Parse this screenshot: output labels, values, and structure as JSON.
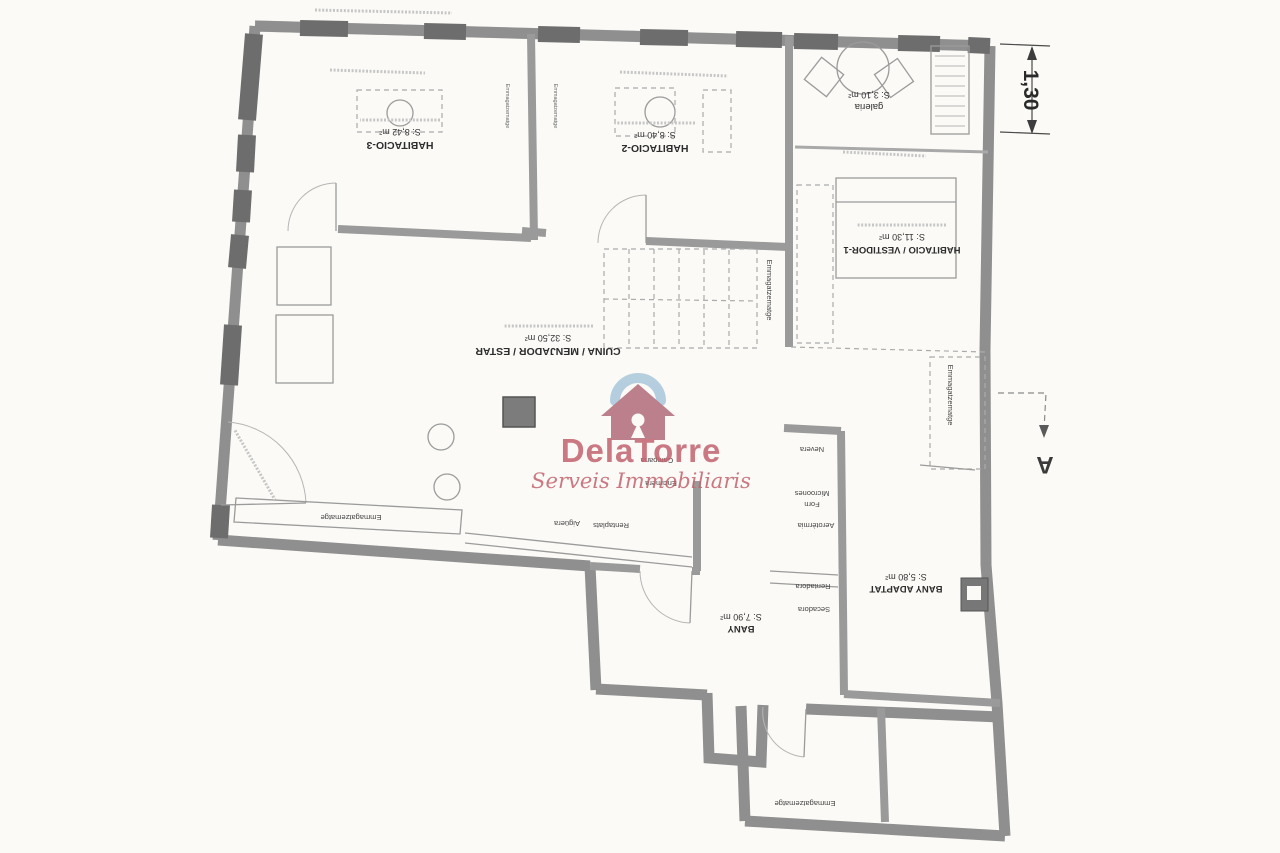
{
  "brand": {
    "name": "DelaTorre",
    "tagline": "Serveis Immobiliaris"
  },
  "rooms": [
    {
      "name": "HABITACIO-3",
      "area": "S: 8,42 m²"
    },
    {
      "name": "HABITACIO-2",
      "area": "S: 8,40 m²"
    },
    {
      "name": "galeria",
      "area": "S: 3,10 m²"
    },
    {
      "name": "HABITACIO / VESTIDOR-1",
      "area": "S: 11,30 m²"
    },
    {
      "name": "CUINA / MENJADOR / ESTAR",
      "area": "S: 32,50 m²"
    },
    {
      "name": "BANY",
      "area": "S: 7,90 m²"
    },
    {
      "name": "BANY ADAPTAT",
      "area": "S: 5,80 m²"
    }
  ],
  "fixtures": {
    "campana": "Campana",
    "encimera": "Encimera",
    "rentaplats": "Rentaplats",
    "aiguera": "Aigüera",
    "nevera": "Nevera",
    "forn": "Forn",
    "microones": "Microones",
    "aerotermia": "Aerotèrmia",
    "rentadora": "Rentadora",
    "secadora": "Secadora",
    "storage": "Emmagatzematge"
  },
  "annotations": {
    "width_dim": "1,30",
    "section_label": "A"
  },
  "colors": {
    "wall": "#8f8f8f",
    "wall_dark": "#6d6d6d",
    "paper": "#fbfaf7",
    "brand_red": "#c2626d",
    "brand_blue": "#a9c7db",
    "brand_rose": "#b26b7a"
  }
}
